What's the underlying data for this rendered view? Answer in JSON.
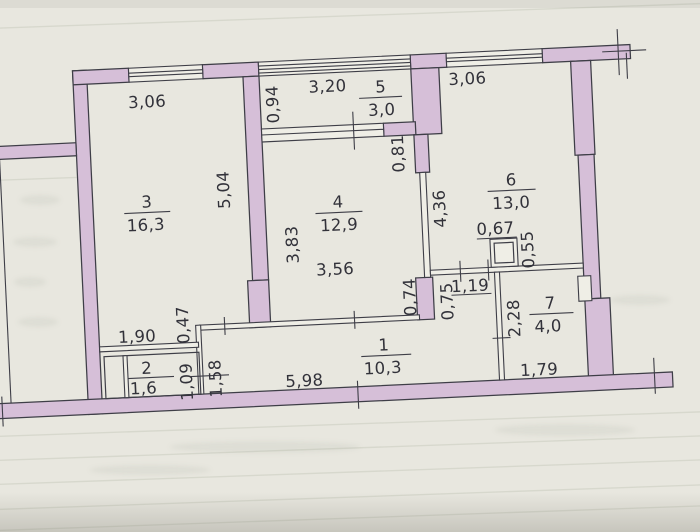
{
  "floor_plan": {
    "rooms": {
      "r1": {
        "number": "1",
        "area": "10,3"
      },
      "r2": {
        "number": "2",
        "area": "1,6"
      },
      "r3": {
        "number": "3",
        "area": "16,3"
      },
      "r4": {
        "number": "4",
        "area": "12,9"
      },
      "r5": {
        "number": "5",
        "area": "3,0"
      },
      "r6": {
        "number": "6",
        "area": "13,0"
      },
      "r7": {
        "number": "7",
        "area": "4,0"
      }
    },
    "dimensions": {
      "room3_width": "3,06",
      "balcony_width": "3,20",
      "room6_width": "3,06",
      "balcony_depth": "0,94",
      "room3_depth": "5,04",
      "room4_depth": "3,83",
      "room4_width": "3,56",
      "wall_inset": "0,81",
      "room6_depth": "4,36",
      "duct_width": "0,67",
      "duct_depth": "0,55",
      "door_room4": "0,74",
      "door_hall": "0,75",
      "opening_room6": "1,19",
      "room7_depth": "2,28",
      "room7_width": "1,79",
      "step_depth": "0,47",
      "nook_width": "1,90",
      "room2_depth": "1,09",
      "hall_left_depth": "1,58",
      "hall_width": "5,98"
    },
    "colors": {
      "wall_fill": "#d6bfd8",
      "line": "#3e3e47",
      "ink": "#32323a",
      "paper": "#e8e7df",
      "paper2": "#efeee6"
    }
  }
}
